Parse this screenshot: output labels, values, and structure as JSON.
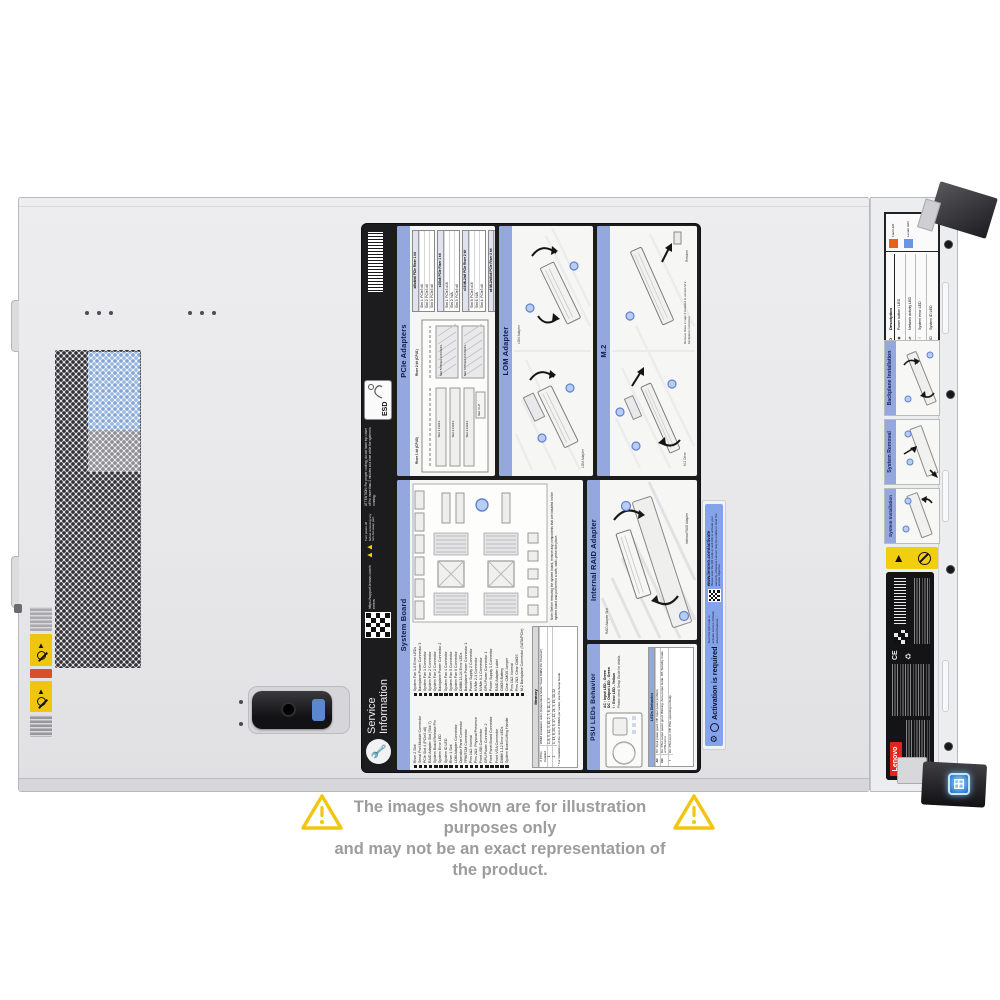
{
  "watermark": {
    "text": "COMPAN"
  },
  "disclaimer": {
    "line1": "The images shown are for illustration purposes only",
    "line2": "and may not be an exact representation of the product."
  },
  "label": {
    "brand": {
      "line1": "Service",
      "line2": "Information"
    },
    "support_url": "https://support.lenovo.com/servers",
    "power_off_warning": "Turn power off before removing any non-hot-swap part.",
    "attention": "ATTENTION: For proper cooling, do not have top cover off for more than 2 minutes at a time while the system is running.",
    "esd": "ESD",
    "pcie": {
      "title": "PCIe Adapters",
      "riser1": "Riser 1 kit (CPU0)",
      "riser2": "Riser 2 kit (CPU1)",
      "slots_r1": [
        "Slot 1 FH/FL",
        "Slot 2 FH/FL",
        "Slot 3 FH/FL"
      ],
      "slots_r2": [
        "Slot 5 PCIe3 x16 FH/FL",
        "Slot 6 PCIe3 x16 FH/FL"
      ],
      "slot4": "Slot 4 LP",
      "tables": [
        {
          "title": "x8/x8/x8 PCIe Riser 1 kit",
          "rows": [
            "Slot 1: PCIe3 x8",
            "Slot 2: PCIe3 x8",
            "Slot 3: PCIe3 x8"
          ]
        },
        {
          "title": "x16/x8 PCIe Riser 1 kit",
          "rows": [
            "Slot 1: PCIe3 x16",
            "Slot 2: N/A",
            "Slot 3: PCIe3 x8"
          ]
        },
        {
          "title": "x16 ML2/x8 PCIe Riser 2 kit",
          "rows": [
            "Slot 5: PCIe3 x16",
            "Slot 6: N/A",
            "Slot 4: PCIe3 x8"
          ]
        },
        {
          "title": "x8 ML2/x8/x8 PCIe Riser 2 kit",
          "rows": [
            "Slot 5: PCIe3 x8",
            "Slot 6: PCIe3 x8",
            "Slot 4: PCIe3 x8"
          ]
        }
      ]
    },
    "lom": {
      "title": "LOM Adapter",
      "callout": "LOM Adapter"
    },
    "m2": {
      "title": "M.2",
      "callout1": "M.2 Drive",
      "callout2": "Retainer",
      "note": "Remove Riser 2 cage if installed to access M.2 backplane connector."
    },
    "system_board": {
      "title": "System Board",
      "legend_left": [
        "Riser 2 Slot",
        "Serial Port Module Connector",
        "PCIe Slot 4 (PCIe3 x8)",
        "RAID Adapter Slot (Slot 7)",
        "System Board Release Pin",
        "System Error LED",
        "System ID LED",
        "Riser 1 Slot",
        "LOM Adapter Connector",
        "Operator Panel Connector",
        "TPM/TCM Connector",
        "Pins 1&2: Normal",
        "Pins 2&3: Physical Presence",
        "Front USB Connector",
        "GPU Power Connector 2",
        "Front Panel Board Connector",
        "Front VGA Connector",
        "DIMM 1-12 Error LEDs",
        "System Board Lifting Handle"
      ],
      "legend_right": [
        "System Fan 1-6 Error LEDs",
        "Backplane Power Connector 3",
        "System Fan 1 Connector",
        "System Fan 2 Connector",
        "System Fan 3 Connector",
        "Backplane Power Connector 2",
        "System Fan 4 Connector",
        "System Fan 5 Connector",
        "System Fan 6 Connector",
        "DIMM 13-24 Error LEDs",
        "Backplane Power Connector 1",
        "Power Supply 2 Connector",
        "NVMe 2-3 Connector",
        "NVMe 0-1 Connector",
        "GPU Power Connector 1",
        "Power Supply 1 Connector",
        "RAID Adapter Label",
        "CMOS Battery",
        "Clear CMOS Jumper",
        "Pins 1&2: Normal",
        "Pins 2&3: Clear CMOS",
        "M.2 Backplane Connector (SATA/PCIe)"
      ],
      "note": "Note: Before removing the system board, remove any components that are installed on the system board and put them in a safe, static-protective place.",
      "memory": {
        "title": "Memory",
        "col1": "# CPUs installed",
        "col2": "DIMM installation order (Independent Mode \"Fixed DIMM Per Channel\")",
        "row1_cpu": "1",
        "row1_order": "1, 8, 5, 12, 3, 10, 2, 7, 6, 11, 4, 9",
        "row2_cpu": "2",
        "row2_order": "1, 13, 8, 20, 5, 17, 12, 24, 3, 15, 10, 22",
        "footnote": "* For installation of the rest of DIMMs per socket, see the Setup Guide."
      }
    },
    "raid": {
      "title": "Internal RAID Adapter",
      "callout1": "RAID Adapter Slot",
      "callout2": "Internal RAID Adapter"
    },
    "psu": {
      "title": "PSU LEDs Behavior",
      "legend": [
        "AC : Input LED - Green",
        "DC : Output LED - Green",
        "!  : Error LED - Yellow"
      ],
      "note": "Please check Setup Guide for details.",
      "table_title": "LEDs Behavior",
      "rows": [
        {
          "led": "AC",
          "desc": "On: Input power good. Off: Input power problem."
        },
        {
          "led": "DC",
          "desc": "On: PSU output power good. Blinking: Zero-output mode. Off: Standby mode or PSU error."
        },
        {
          "led": "!",
          "desc": "On: PSU error. Off: PSU operating normally."
        }
      ]
    }
  },
  "activation": {
    "title": "Activation is required",
    "line1": "Scan the QR code to activate Lenovo XClarity advanced features.",
    "url": "www.lenovo.com/activate",
    "line2": "Please scan the QR code or web link to activate your warranty, otherwise Lenovo may be unable to meet the service objective."
  },
  "rail": {
    "led_label": {
      "col_led": "LED",
      "col_desc": "Description",
      "fault_caption": "Fault LED",
      "locate_caption": "Locate LED",
      "rows": [
        {
          "led": "◉",
          "desc": "Power button / LED"
        },
        {
          "led": "⇄",
          "desc": "Network activity LED"
        },
        {
          "led": "!",
          "desc": "System error LED"
        },
        {
          "led": "ID",
          "desc": "System ID LED"
        }
      ]
    },
    "sections": [
      "Backplane Installation",
      "System Removal",
      "System Installation"
    ],
    "lenovo": "Lenovo",
    "cert": "CE"
  }
}
